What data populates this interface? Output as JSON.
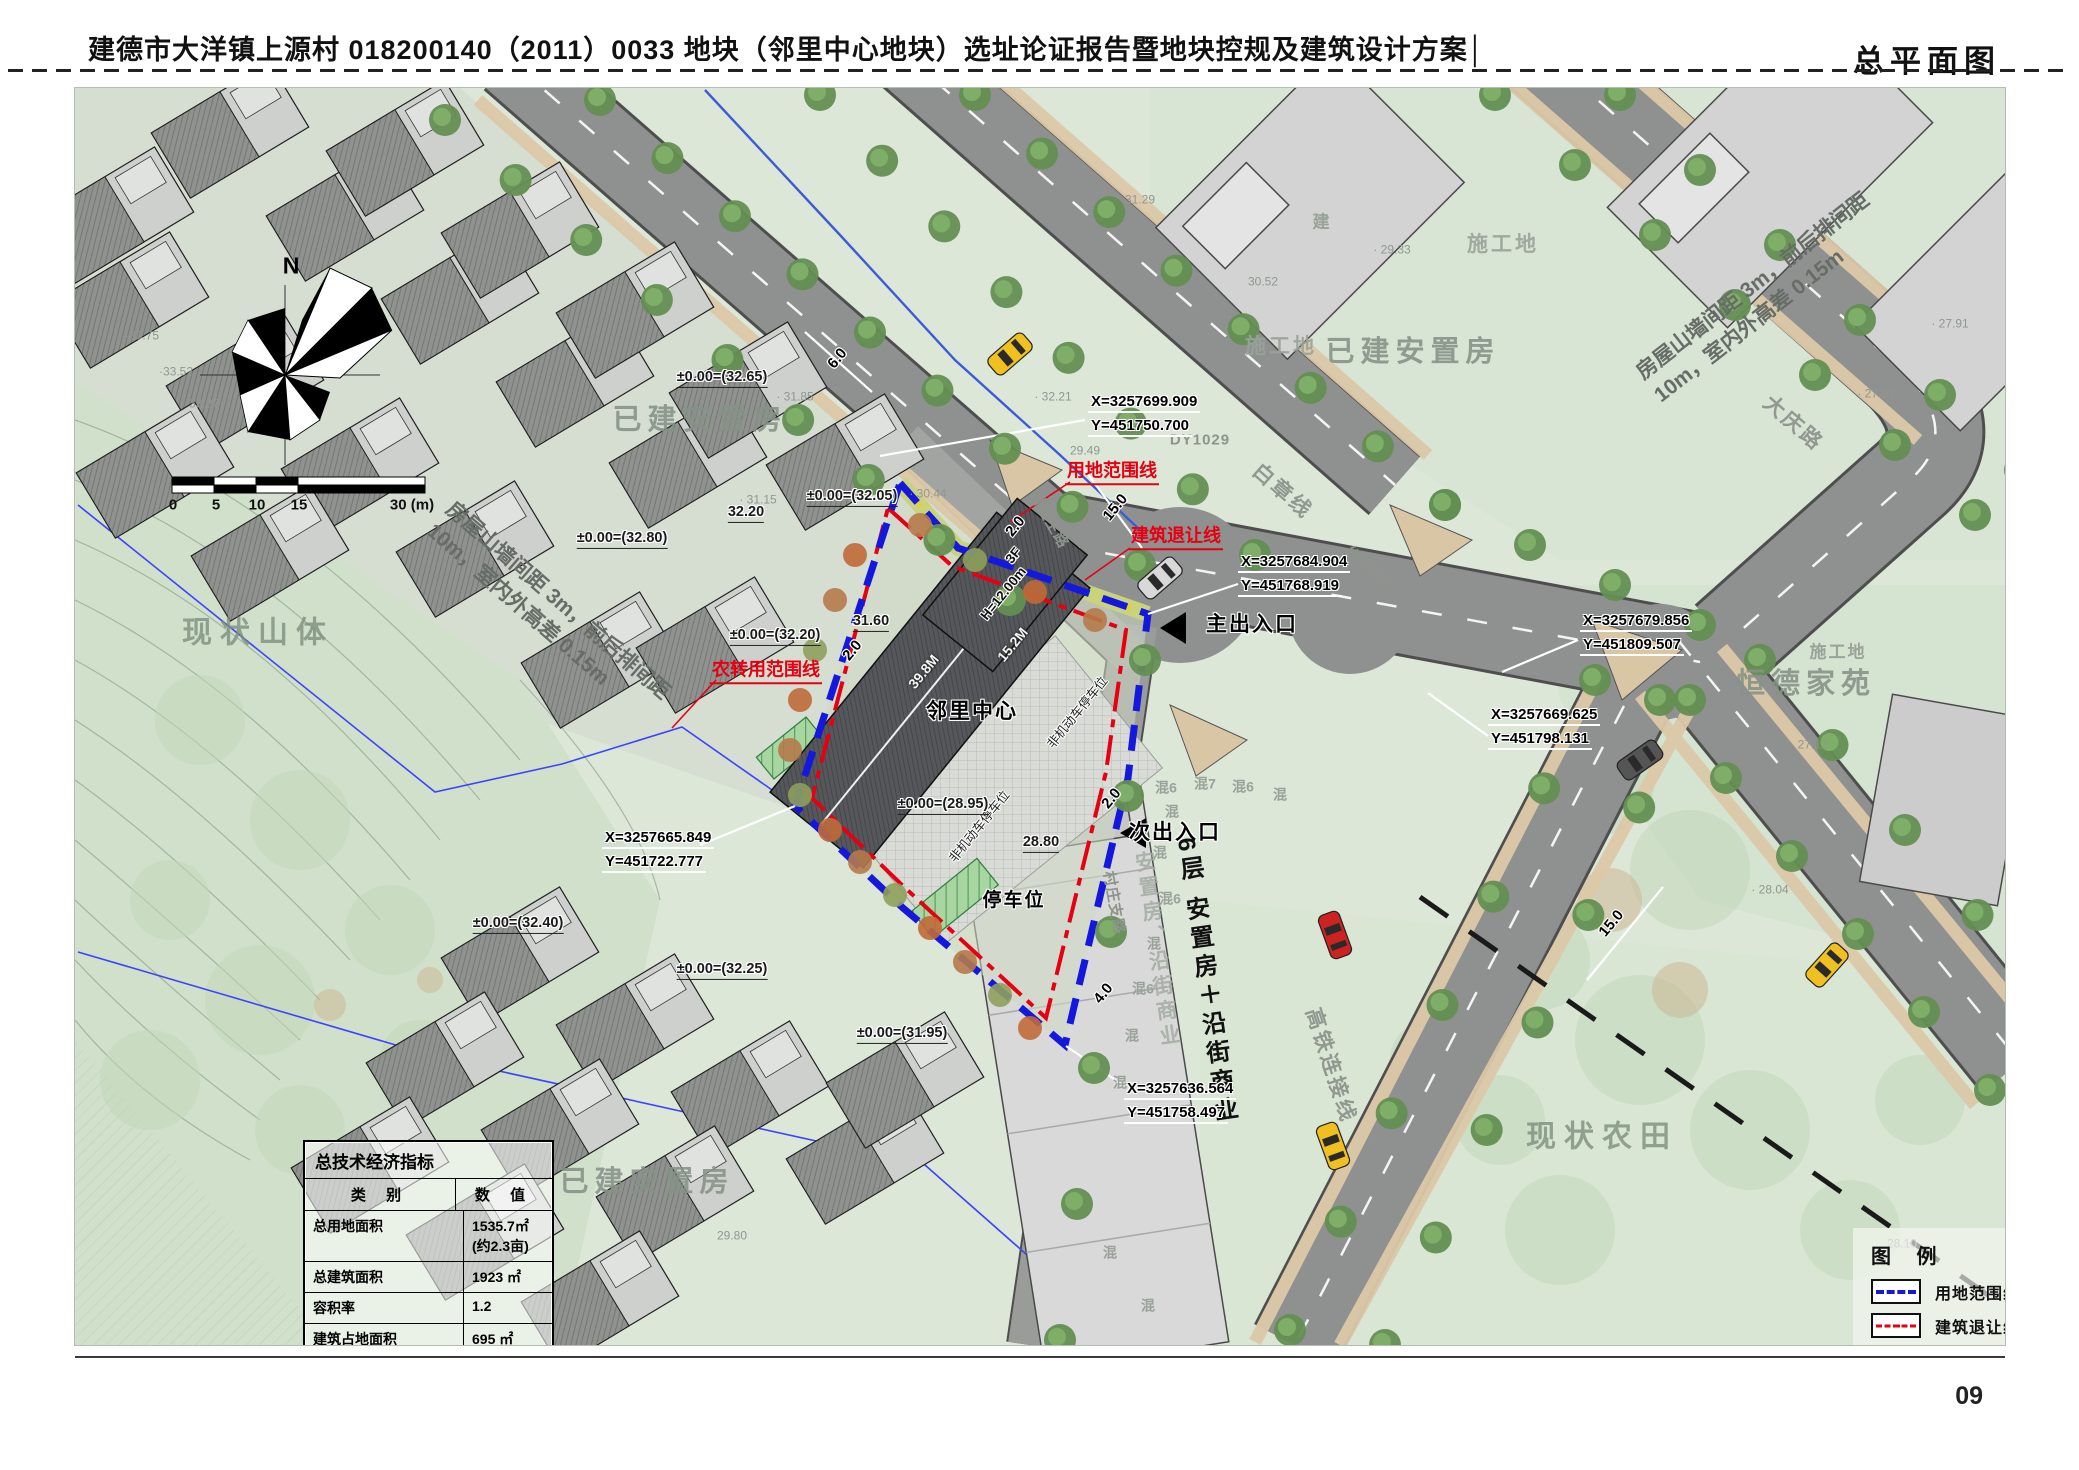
{
  "header": {
    "title": "建德市大洋镇上源村 018200140（2011）0033 地块（邻里中心地块）选址论证报告暨地块控规及建筑设计方案│",
    "page_label": "总平面图"
  },
  "footer": {
    "page_number": "09"
  },
  "table": {
    "title": "总技术经济指标",
    "col_category": "类  别",
    "col_value": "数  值",
    "rows": [
      {
        "label": "总用地面积",
        "value": "1535.7㎡ (约2.3亩)"
      },
      {
        "label": "总建筑面积",
        "value": "1923 ㎡"
      },
      {
        "label": "容积率",
        "value": "1.2"
      },
      {
        "label": "建筑占地面积",
        "value": "695 ㎡"
      },
      {
        "label": "建筑密度",
        "value": "45.2%"
      },
      {
        "label": "绿化率",
        "value": "10.3%"
      },
      {
        "label": "机动车停车位",
        "value": "6(个)"
      },
      {
        "label": "非机动车停车位",
        "value": "20(个)"
      }
    ]
  },
  "legend": {
    "title": "图 例",
    "items": [
      {
        "label": "用地范围线",
        "type": "blue-dash"
      },
      {
        "label": "建筑退让线",
        "type": "red-dashdot"
      },
      {
        "label": "规划建筑",
        "type": "building"
      },
      {
        "label": "规划道路",
        "type": "road"
      },
      {
        "label": "停车位",
        "type": "parking"
      }
    ]
  },
  "colors": {
    "boundary_blue": "#1418dc",
    "setback_red": "#e60012",
    "road_gray": "#8f9190",
    "map_green": "#dce7d8"
  },
  "coordinates": [
    {
      "name": "coord-1",
      "x_label": "X=3257699.909",
      "y_label": "Y=451750.700",
      "x": 1088,
      "y": 393
    },
    {
      "name": "coord-2",
      "x_label": "X=3257684.904",
      "y_label": "Y=451768.919",
      "x": 1238,
      "y": 553
    },
    {
      "name": "coord-3",
      "x_label": "X=3257679.856",
      "y_label": "Y=451809.507",
      "x": 1580,
      "y": 612
    },
    {
      "name": "coord-4",
      "x_label": "X=3257669.625",
      "y_label": "Y=451798.131",
      "x": 1488,
      "y": 706
    },
    {
      "name": "coord-5",
      "x_label": "X=3257665.849",
      "y_label": "Y=451722.777",
      "x": 602,
      "y": 829
    },
    {
      "name": "coord-6",
      "x_label": "X=3257636.564",
      "y_label": "Y=451758.497",
      "x": 1124,
      "y": 1080
    }
  ],
  "labels": [
    {
      "n": "label-existing-resettlement-1",
      "t": "已建安置房",
      "x": 700,
      "y": 420,
      "r": 0,
      "c": "area"
    },
    {
      "n": "label-existing-resettlement-2",
      "t": "已建安置房",
      "x": 1413,
      "y": 352,
      "r": 0,
      "c": "area"
    },
    {
      "n": "label-existing-resettlement-3",
      "t": "已建安置房",
      "x": 647,
      "y": 1182,
      "r": 0,
      "c": "area"
    },
    {
      "n": "label-construction-site-1",
      "t": "施工地",
      "x": 1503,
      "y": 245,
      "r": 0,
      "c": "area2"
    },
    {
      "n": "label-construction-site-2",
      "t": "施工地",
      "x": 1281,
      "y": 347,
      "r": 0,
      "c": "area2"
    },
    {
      "n": "label-construction-site-3",
      "t": "施工地",
      "x": 1838,
      "y": 652,
      "r": 0,
      "c": "area3"
    },
    {
      "n": "label-hengde-jiayuan",
      "t": "恒德家苑",
      "x": 1806,
      "y": 684,
      "r": 0,
      "c": "area"
    },
    {
      "n": "label-existing-mountain",
      "t": "现状山体",
      "x": 258,
      "y": 633,
      "r": 0,
      "c": "areaBig"
    },
    {
      "n": "label-existing-farmland",
      "t": "现状农田",
      "x": 1602,
      "y": 1137,
      "r": 0,
      "c": "areaBig"
    },
    {
      "n": "label-jian",
      "t": "建",
      "x": 1322,
      "y": 222,
      "r": 0,
      "c": "area3"
    },
    {
      "n": "label-road-baizhangxian",
      "t": "白章线",
      "x": 1282,
      "y": 492,
      "r": 41,
      "c": "road"
    },
    {
      "n": "label-road-x610",
      "t": "(X610)",
      "x": 1367,
      "y": 566,
      "r": 41,
      "c": "roadS"
    },
    {
      "n": "label-road-dy1029",
      "t": "DY1029",
      "x": 1200,
      "y": 441,
      "r": 0,
      "c": "roadS"
    },
    {
      "n": "label-road-daqinglu",
      "t": "大庆路",
      "x": 1793,
      "y": 424,
      "r": 41,
      "c": "road"
    },
    {
      "n": "label-road-village-main",
      "t": "村庄主路",
      "x": 1048,
      "y": 520,
      "r": 60,
      "c": "roadS"
    },
    {
      "n": "label-road-village-branch",
      "t": "村庄支路",
      "x": 1113,
      "y": 903,
      "r": 80,
      "c": "roadS"
    },
    {
      "n": "label-road-hsr-link",
      "t": "高铁连接线",
      "x": 1330,
      "y": 1066,
      "r": 72,
      "c": "road"
    },
    {
      "n": "note-spacing-right",
      "t": "房屋山墙间距 3m，前后排间距\n10m，室内外高差 0.15m",
      "x": 1762,
      "y": 298,
      "r": -38,
      "c": "note"
    },
    {
      "n": "note-spacing-left",
      "t": "房屋山墙间距 3m，前后排间距\n10m，室内外高差 0.15m",
      "x": 548,
      "y": 612,
      "r": 41,
      "c": "note"
    },
    {
      "n": "label-site-boundary",
      "t": "用地范围线",
      "x": 1112,
      "y": 472,
      "r": 0,
      "c": "red"
    },
    {
      "n": "label-setback-line",
      "t": "建筑退让线",
      "x": 1176,
      "y": 537,
      "r": 0,
      "c": "red"
    },
    {
      "n": "label-farm-conversion-line",
      "t": "农转用范围线",
      "x": 766,
      "y": 671,
      "r": 0,
      "c": "red"
    },
    {
      "n": "label-neighborhood-center",
      "t": "邻里中心",
      "x": 972,
      "y": 712,
      "r": 0,
      "c": "site halo"
    },
    {
      "n": "label-parking",
      "t": "停车位",
      "x": 1014,
      "y": 901,
      "r": 0,
      "c": "siteS halo"
    },
    {
      "n": "label-nonmotor-parking-1",
      "t": "非机动车停车位",
      "x": 1078,
      "y": 713,
      "r": -51,
      "c": "tiny halo"
    },
    {
      "n": "label-nonmotor-parking-2",
      "t": "非机动车停车位",
      "x": 980,
      "y": 827,
      "r": -51,
      "c": "tiny halo"
    },
    {
      "n": "label-main-entrance",
      "t": "主出入口",
      "x": 1252,
      "y": 625,
      "r": 0,
      "c": "site halo"
    },
    {
      "n": "label-secondary-entrance",
      "t": "次出入口",
      "x": 1175,
      "y": 833,
      "r": 0,
      "c": "site halo"
    },
    {
      "n": "label-floors",
      "t": "3F",
      "x": 1014,
      "y": 556,
      "r": -51,
      "c": "tinyB halo"
    },
    {
      "n": "label-height",
      "t": "H=12.00m",
      "x": 1004,
      "y": 594,
      "r": -51,
      "c": "tinyB halo"
    },
    {
      "n": "dim-building-length",
      "t": "39.8M",
      "x": 924,
      "y": 672,
      "r": -51,
      "c": "wht"
    },
    {
      "n": "dim-building-width",
      "t": "15.2M",
      "x": 1013,
      "y": 645,
      "r": -51,
      "c": "wht"
    },
    {
      "n": "label-mixed-commercial",
      "t": "6层 安置房＋沿街商业",
      "x": 1205,
      "y": 982,
      "r": -8,
      "c": "bizV"
    },
    {
      "n": "label-mixed-commercial-ghost",
      "t": "安置房、沿街商业",
      "x": 1156,
      "y": 950,
      "r": -8,
      "c": "bizGhost"
    },
    {
      "n": "dim-6.0",
      "t": "6.0",
      "x": 838,
      "y": 359,
      "r": -51,
      "c": "dim halo"
    },
    {
      "n": "dim-15.0-a",
      "t": "15.0",
      "x": 1116,
      "y": 508,
      "r": -51,
      "c": "dim halo"
    },
    {
      "n": "dim-2.0-a",
      "t": "2.0",
      "x": 1016,
      "y": 527,
      "r": -51,
      "c": "dim halo"
    },
    {
      "n": "dim-2.0-b",
      "t": "2.0",
      "x": 853,
      "y": 651,
      "r": -51,
      "c": "dim halo"
    },
    {
      "n": "dim-2.0-c",
      "t": "2.0",
      "x": 1112,
      "y": 799,
      "r": -51,
      "c": "dim halo"
    },
    {
      "n": "dim-4.0",
      "t": "4.0",
      "x": 1104,
      "y": 994,
      "r": -51,
      "c": "dim halo"
    },
    {
      "n": "dim-15.0-b",
      "t": "15.0",
      "x": 1612,
      "y": 924,
      "r": -50,
      "c": "dim halo"
    },
    {
      "n": "elev-32.65",
      "t": "±0.00=(32.65)",
      "x": 722,
      "y": 378,
      "r": 0,
      "c": "elev halo"
    },
    {
      "n": "elev-32.05",
      "t": "±0.00=(32.05)",
      "x": 852,
      "y": 497,
      "r": 0,
      "c": "elev halo"
    },
    {
      "n": "elev-32.80",
      "t": "±0.00=(32.80)",
      "x": 622,
      "y": 539,
      "r": 0,
      "c": "elev halo"
    },
    {
      "n": "elev-32.20",
      "t": "±0.00=(32.20)",
      "x": 775,
      "y": 636,
      "r": 0,
      "c": "elev halo"
    },
    {
      "n": "elev-28.95",
      "t": "±0.00=(28.95)",
      "x": 943,
      "y": 805,
      "r": 0,
      "c": "elev halo"
    },
    {
      "n": "elev-32.40",
      "t": "±0.00=(32.40)",
      "x": 518,
      "y": 924,
      "r": 0,
      "c": "elev halo"
    },
    {
      "n": "elev-32.25",
      "t": "±0.00=(32.25)",
      "x": 722,
      "y": 970,
      "r": 0,
      "c": "elev halo"
    },
    {
      "n": "elev-31.95",
      "t": "±0.00=(31.95)",
      "x": 902,
      "y": 1034,
      "r": 0,
      "c": "elev halo"
    },
    {
      "n": "elev-32.20b",
      "t": "32.20",
      "x": 746,
      "y": 513,
      "r": 0,
      "c": "elev halo"
    },
    {
      "n": "elev-31.60",
      "t": "31.60",
      "x": 871,
      "y": 622,
      "r": 0,
      "c": "elev halo"
    },
    {
      "n": "elev-28.80",
      "t": "28.80",
      "x": 1041,
      "y": 843,
      "r": 0,
      "c": "elev halo"
    },
    {
      "n": "spot",
      "t": "· 31.85",
      "x": 795,
      "y": 397,
      "r": 0,
      "c": "spot"
    },
    {
      "n": "spot",
      "t": "· 31.15",
      "x": 758,
      "y": 500,
      "r": 0,
      "c": "spot"
    },
    {
      "n": "spot",
      "t": "· 30.44",
      "x": 928,
      "y": 494,
      "r": 0,
      "c": "spot"
    },
    {
      "n": "spot",
      "t": "· 32.21",
      "x": 1053,
      "y": 397,
      "r": 0,
      "c": "spot"
    },
    {
      "n": "spot",
      "t": "31.29",
      "x": 1140,
      "y": 200,
      "r": 0,
      "c": "spot"
    },
    {
      "n": "spot",
      "t": "30.52",
      "x": 1263,
      "y": 282,
      "r": 0,
      "c": "spot"
    },
    {
      "n": "spot",
      "t": "29.49",
      "x": 1085,
      "y": 451,
      "r": 0,
      "c": "spot"
    },
    {
      "n": "spot",
      "t": "· 29.33",
      "x": 1392,
      "y": 250,
      "r": 0,
      "c": "spot"
    },
    {
      "n": "spot",
      "t": "· 27.91",
      "x": 1950,
      "y": 324,
      "r": 0,
      "c": "spot"
    },
    {
      "n": "spot",
      "t": "· 27.91",
      "x": 1876,
      "y": 394,
      "r": 0,
      "c": "spot"
    },
    {
      "n": "spot",
      "t": "· 27.12",
      "x": 1809,
      "y": 745,
      "r": 0,
      "c": "spot"
    },
    {
      "n": "spot",
      "t": "· 28.04",
      "x": 1770,
      "y": 890,
      "r": 0,
      "c": "spot"
    },
    {
      "n": "spot",
      "t": "28.10",
      "x": 1902,
      "y": 1244,
      "r": 0,
      "c": "spot"
    },
    {
      "n": "spot",
      "t": "·33.75",
      "x": 142,
      "y": 336,
      "r": 0,
      "c": "spot"
    },
    {
      "n": "spot",
      "t": "·33.52",
      "x": 176,
      "y": 372,
      "r": 0,
      "c": "spot"
    },
    {
      "n": "spot",
      "t": "·33.27",
      "x": 202,
      "y": 404,
      "r": 0,
      "c": "spot"
    },
    {
      "n": "spot",
      "t": "29.80",
      "x": 732,
      "y": 1236,
      "r": 0,
      "c": "spot"
    },
    {
      "n": "mix",
      "t": "混6",
      "x": 1166,
      "y": 788,
      "r": 0,
      "c": "mix"
    },
    {
      "n": "mix",
      "t": "混7",
      "x": 1205,
      "y": 784,
      "r": 0,
      "c": "mix"
    },
    {
      "n": "mix",
      "t": "混6",
      "x": 1243,
      "y": 787,
      "r": 0,
      "c": "mix"
    },
    {
      "n": "mix",
      "t": "混",
      "x": 1280,
      "y": 795,
      "r": 0,
      "c": "mix"
    },
    {
      "n": "mix",
      "t": "混",
      "x": 1172,
      "y": 812,
      "r": 0,
      "c": "mix"
    },
    {
      "n": "mix",
      "t": "混",
      "x": 1160,
      "y": 853,
      "r": 0,
      "c": "mix"
    },
    {
      "n": "mix",
      "t": "混6",
      "x": 1170,
      "y": 899,
      "r": 0,
      "c": "mix"
    },
    {
      "n": "mix",
      "t": "混",
      "x": 1154,
      "y": 944,
      "r": 0,
      "c": "mix"
    },
    {
      "n": "mix",
      "t": "混6",
      "x": 1143,
      "y": 989,
      "r": 0,
      "c": "mix"
    },
    {
      "n": "mix",
      "t": "混",
      "x": 1132,
      "y": 1036,
      "r": 0,
      "c": "mix"
    },
    {
      "n": "mix",
      "t": "混",
      "x": 1120,
      "y": 1083,
      "r": 0,
      "c": "mix"
    },
    {
      "n": "mix",
      "t": "混",
      "x": 1148,
      "y": 1306,
      "r": 0,
      "c": "mix"
    },
    {
      "n": "mix",
      "t": "混",
      "x": 1110,
      "y": 1253,
      "r": 0,
      "c": "mix"
    },
    {
      "n": "compass-n",
      "t": "N",
      "x": 291,
      "y": 266,
      "r": 0,
      "c": "north"
    },
    {
      "n": "scale-0",
      "t": "0",
      "x": 173,
      "y": 506,
      "r": 0,
      "c": "scale"
    },
    {
      "n": "scale-5",
      "t": "5",
      "x": 216,
      "y": 506,
      "r": 0,
      "c": "scale"
    },
    {
      "n": "scale-10",
      "t": "10",
      "x": 257,
      "y": 506,
      "r": 0,
      "c": "scale"
    },
    {
      "n": "scale-15",
      "t": "15",
      "x": 299,
      "y": 506,
      "r": 0,
      "c": "scale"
    },
    {
      "n": "scale-30",
      "t": "30 (m)",
      "x": 412,
      "y": 506,
      "r": 0,
      "c": "scale"
    }
  ]
}
